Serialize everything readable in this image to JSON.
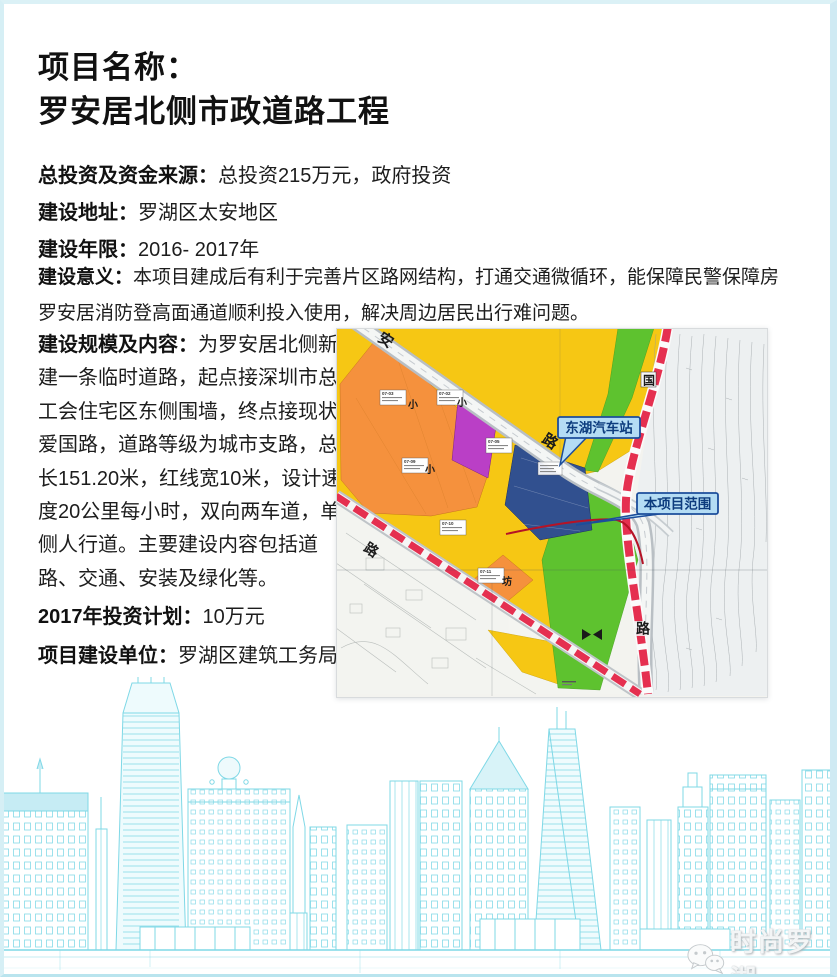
{
  "page": {
    "title_line1": "项目名称：",
    "title_line2": "罗安居北侧市政道路工程"
  },
  "fields": {
    "investment": {
      "label": "总投资及资金来源：",
      "value": "总投资215万元，政府投资"
    },
    "address": {
      "label": "建设地址：",
      "value": "罗湖区太安地区"
    },
    "years": {
      "label": "建设年限：",
      "value": "2016- 2017年"
    },
    "significance": {
      "label": "建设意义：",
      "value": "本项目建成后有利于完善片区路网结构，打通交通微循环，能保障民警保障房罗安居消防登高面通道顺利投入使用，解决周边居民出行难问题。"
    },
    "scale": {
      "label": "建设规模及内容：",
      "value": "为罗安居北侧新建一条临时道路，起点接深圳市总工会住宅区东侧围墙，终点接现状爱国路，道路等级为城市支路，总长151.20米，红线宽10米，设计速度20公里每小时，双向两车道，单侧人行道。主要建设内容包括道路、交通、安装及绿化等。"
    },
    "plan2017": {
      "label": "2017年投资计划：",
      "value": "10万元"
    },
    "builder": {
      "label": "项目建设单位：",
      "value": "罗湖区建筑工务局"
    }
  },
  "map": {
    "callouts": {
      "bus_station": "东湖汽车站",
      "project_scope": "本项目范围"
    },
    "road_labels": {
      "an": "安",
      "lu_main": "路",
      "guo": "国",
      "lu_vertical": "路",
      "lu_lower": "路"
    },
    "area_labels": {
      "xiao1": "小",
      "xiao2": "小",
      "xiao3": "小",
      "fang": "坊"
    },
    "parcels": [
      {
        "code": "07-03"
      },
      {
        "code": "07-02"
      },
      {
        "code": "07-05"
      },
      {
        "code": "07-09"
      },
      {
        "code": "07-10"
      },
      {
        "code": "07-11"
      }
    ],
    "colors": {
      "orange": "#f5913d",
      "yellow": "#f6c714",
      "purple": "#ba3fc6",
      "dark_blue": "#31508f",
      "green": "#5ec22f",
      "red_road": "#e53050",
      "callout_fill": "#b4dcf4",
      "callout_border": "#1c4d9b",
      "skyline": "#7fd8e6"
    }
  },
  "watermark": {
    "text": "时尚罗湖"
  }
}
